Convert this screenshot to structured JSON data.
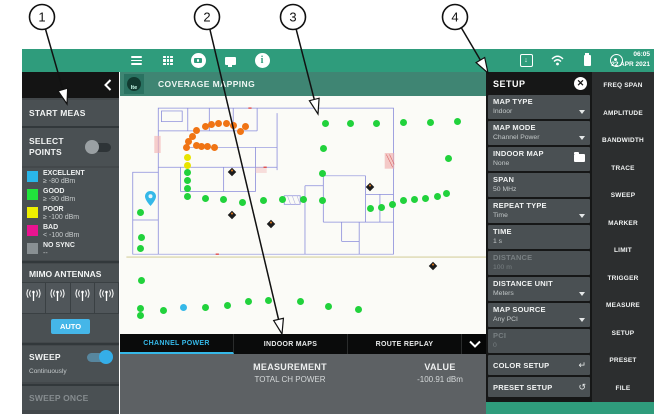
{
  "top_bar": {
    "time": "06:05",
    "date": "22 APR 2021",
    "icons": [
      "menu-icon",
      "apps-grid-icon",
      "camera-icon",
      "display-icon",
      "info-icon",
      "screenshot-icon",
      "wifi-icon",
      "battery-icon",
      "gps-icon"
    ]
  },
  "header": {
    "title": "COVERAGE MAPPING",
    "badge": "lte"
  },
  "left_panel": {
    "start_meas": "START MEAS",
    "select_points": "SELECT POINTS",
    "select_points_on": false,
    "legend": [
      {
        "label": "EXCELLENT",
        "sub": "≥ -80 dBm",
        "color": "#29b5e8"
      },
      {
        "label": "GOOD",
        "sub": "≥ -90 dBm",
        "color": "#21e43c"
      },
      {
        "label": "POOR",
        "sub": "≥ -100 dBm",
        "color": "#eef000"
      },
      {
        "label": "BAD",
        "sub": "< -100 dBm",
        "color": "#ea1390"
      },
      {
        "label": "NO SYNC",
        "sub": "--",
        "color": "#899093"
      }
    ],
    "mimo_label": "MIMO ANTENNAS",
    "antenna_count": 4,
    "auto_label": "AUTO",
    "sweep_label": "SWEEP",
    "sweep_on": true,
    "sweep_mode": "Continuously",
    "sweep_once": "SWEEP ONCE"
  },
  "tabs": [
    {
      "label": "CHANNEL POWER",
      "active": true
    },
    {
      "label": "INDOOR MAPS",
      "active": false
    },
    {
      "label": "ROUTE REPLAY",
      "active": false
    }
  ],
  "readout": {
    "measurement_label": "MEASUREMENT",
    "measurement": "TOTAL CH POWER",
    "value_label": "VALUE",
    "value": "-100.91 dBm"
  },
  "setup_panel": {
    "title": "SETUP",
    "items": [
      {
        "label": "MAP TYPE",
        "value": "Indoor",
        "icon": "caret",
        "disabled": false
      },
      {
        "label": "MAP MODE",
        "value": "Channel Power",
        "icon": "caret",
        "disabled": false
      },
      {
        "label": "INDOOR MAP",
        "value": "None",
        "icon": "folder",
        "disabled": false
      },
      {
        "label": "SPAN",
        "value": "50 MHz",
        "icon": "none",
        "disabled": false
      },
      {
        "label": "REPEAT TYPE",
        "value": "Time",
        "icon": "caret",
        "disabled": false
      },
      {
        "label": "TIME",
        "value": "1 s",
        "icon": "none",
        "disabled": false
      },
      {
        "label": "DISTANCE",
        "value": "100 m",
        "icon": "none",
        "disabled": true
      },
      {
        "label": "DISTANCE UNIT",
        "value": "Meters",
        "icon": "caret",
        "disabled": false
      },
      {
        "label": "MAP SOURCE",
        "value": "Any PCI",
        "icon": "caret",
        "disabled": false
      },
      {
        "label": "PCI",
        "value": "0",
        "icon": "none",
        "disabled": true
      }
    ],
    "actions": [
      {
        "label": "COLOR SETUP",
        "icon": "return-icon",
        "glyph": "↵"
      },
      {
        "label": "PRESET SETUP",
        "icon": "reset-icon",
        "glyph": "↺"
      }
    ]
  },
  "right_menu": [
    "FREQ SPAN",
    "AMPLITUDE",
    "BANDWIDTH",
    "TRACE",
    "SWEEP",
    "MARKER",
    "LIMIT",
    "TRIGGER",
    "MEASURE",
    "SETUP",
    "PRESET",
    "FILE"
  ],
  "callouts": [
    {
      "label": "1",
      "cx": 42,
      "cy": 17,
      "tip_x": 67,
      "tip_y": 104
    },
    {
      "label": "2",
      "cx": 207,
      "cy": 17,
      "tip_x": 282,
      "tip_y": 334
    },
    {
      "label": "3",
      "cx": 293,
      "cy": 17,
      "tip_x": 318,
      "tip_y": 114
    },
    {
      "label": "4",
      "cx": 455,
      "cy": 17,
      "tip_x": 488,
      "tip_y": 73
    }
  ],
  "map": {
    "colors": {
      "good": "#21d23c",
      "excellent": "#35b8e8",
      "poor": "#e8e400",
      "bad_cluster": "#f07414"
    },
    "green_dots": [
      [
        325,
        123
      ],
      [
        350,
        123
      ],
      [
        376,
        123
      ],
      [
        403,
        122
      ],
      [
        430,
        122
      ],
      [
        457,
        121
      ],
      [
        448,
        158
      ],
      [
        323,
        148
      ],
      [
        322,
        173
      ],
      [
        322,
        200
      ],
      [
        303,
        199
      ],
      [
        370,
        208
      ],
      [
        381,
        207
      ],
      [
        392,
        204
      ],
      [
        403,
        200
      ],
      [
        414,
        199
      ],
      [
        425,
        198
      ],
      [
        437,
        196
      ],
      [
        446,
        193
      ],
      [
        140,
        212
      ],
      [
        141,
        237
      ],
      [
        140,
        248
      ],
      [
        141,
        280
      ],
      [
        140,
        308
      ],
      [
        187,
        172
      ],
      [
        187,
        180
      ],
      [
        187,
        188
      ],
      [
        187,
        196
      ],
      [
        205,
        198
      ],
      [
        223,
        199
      ],
      [
        242,
        202
      ],
      [
        263,
        200
      ],
      [
        282,
        199
      ],
      [
        140,
        315
      ],
      [
        163,
        310
      ],
      [
        205,
        307
      ],
      [
        227,
        305
      ],
      [
        248,
        301
      ],
      [
        268,
        300
      ],
      [
        300,
        301
      ],
      [
        328,
        306
      ],
      [
        358,
        309
      ]
    ],
    "orange_dots": [
      [
        205,
        126
      ],
      [
        211,
        124
      ],
      [
        218,
        123
      ],
      [
        226,
        123
      ],
      [
        233,
        125
      ],
      [
        245,
        126
      ],
      [
        240,
        131
      ],
      [
        196,
        130
      ],
      [
        192,
        136
      ],
      [
        188,
        141
      ],
      [
        186,
        147
      ],
      [
        196,
        145
      ],
      [
        201,
        146
      ],
      [
        207,
        146
      ],
      [
        214,
        147
      ]
    ],
    "yellow_dots": [
      [
        187,
        157
      ],
      [
        187,
        165
      ]
    ],
    "cyan_dots": [
      [
        183,
        307
      ]
    ],
    "pin": [
      150,
      204
    ],
    "markers": [
      [
        232,
        172
      ],
      [
        232,
        215
      ],
      [
        271,
        224
      ],
      [
        370,
        187
      ],
      [
        433,
        266
      ]
    ]
  }
}
